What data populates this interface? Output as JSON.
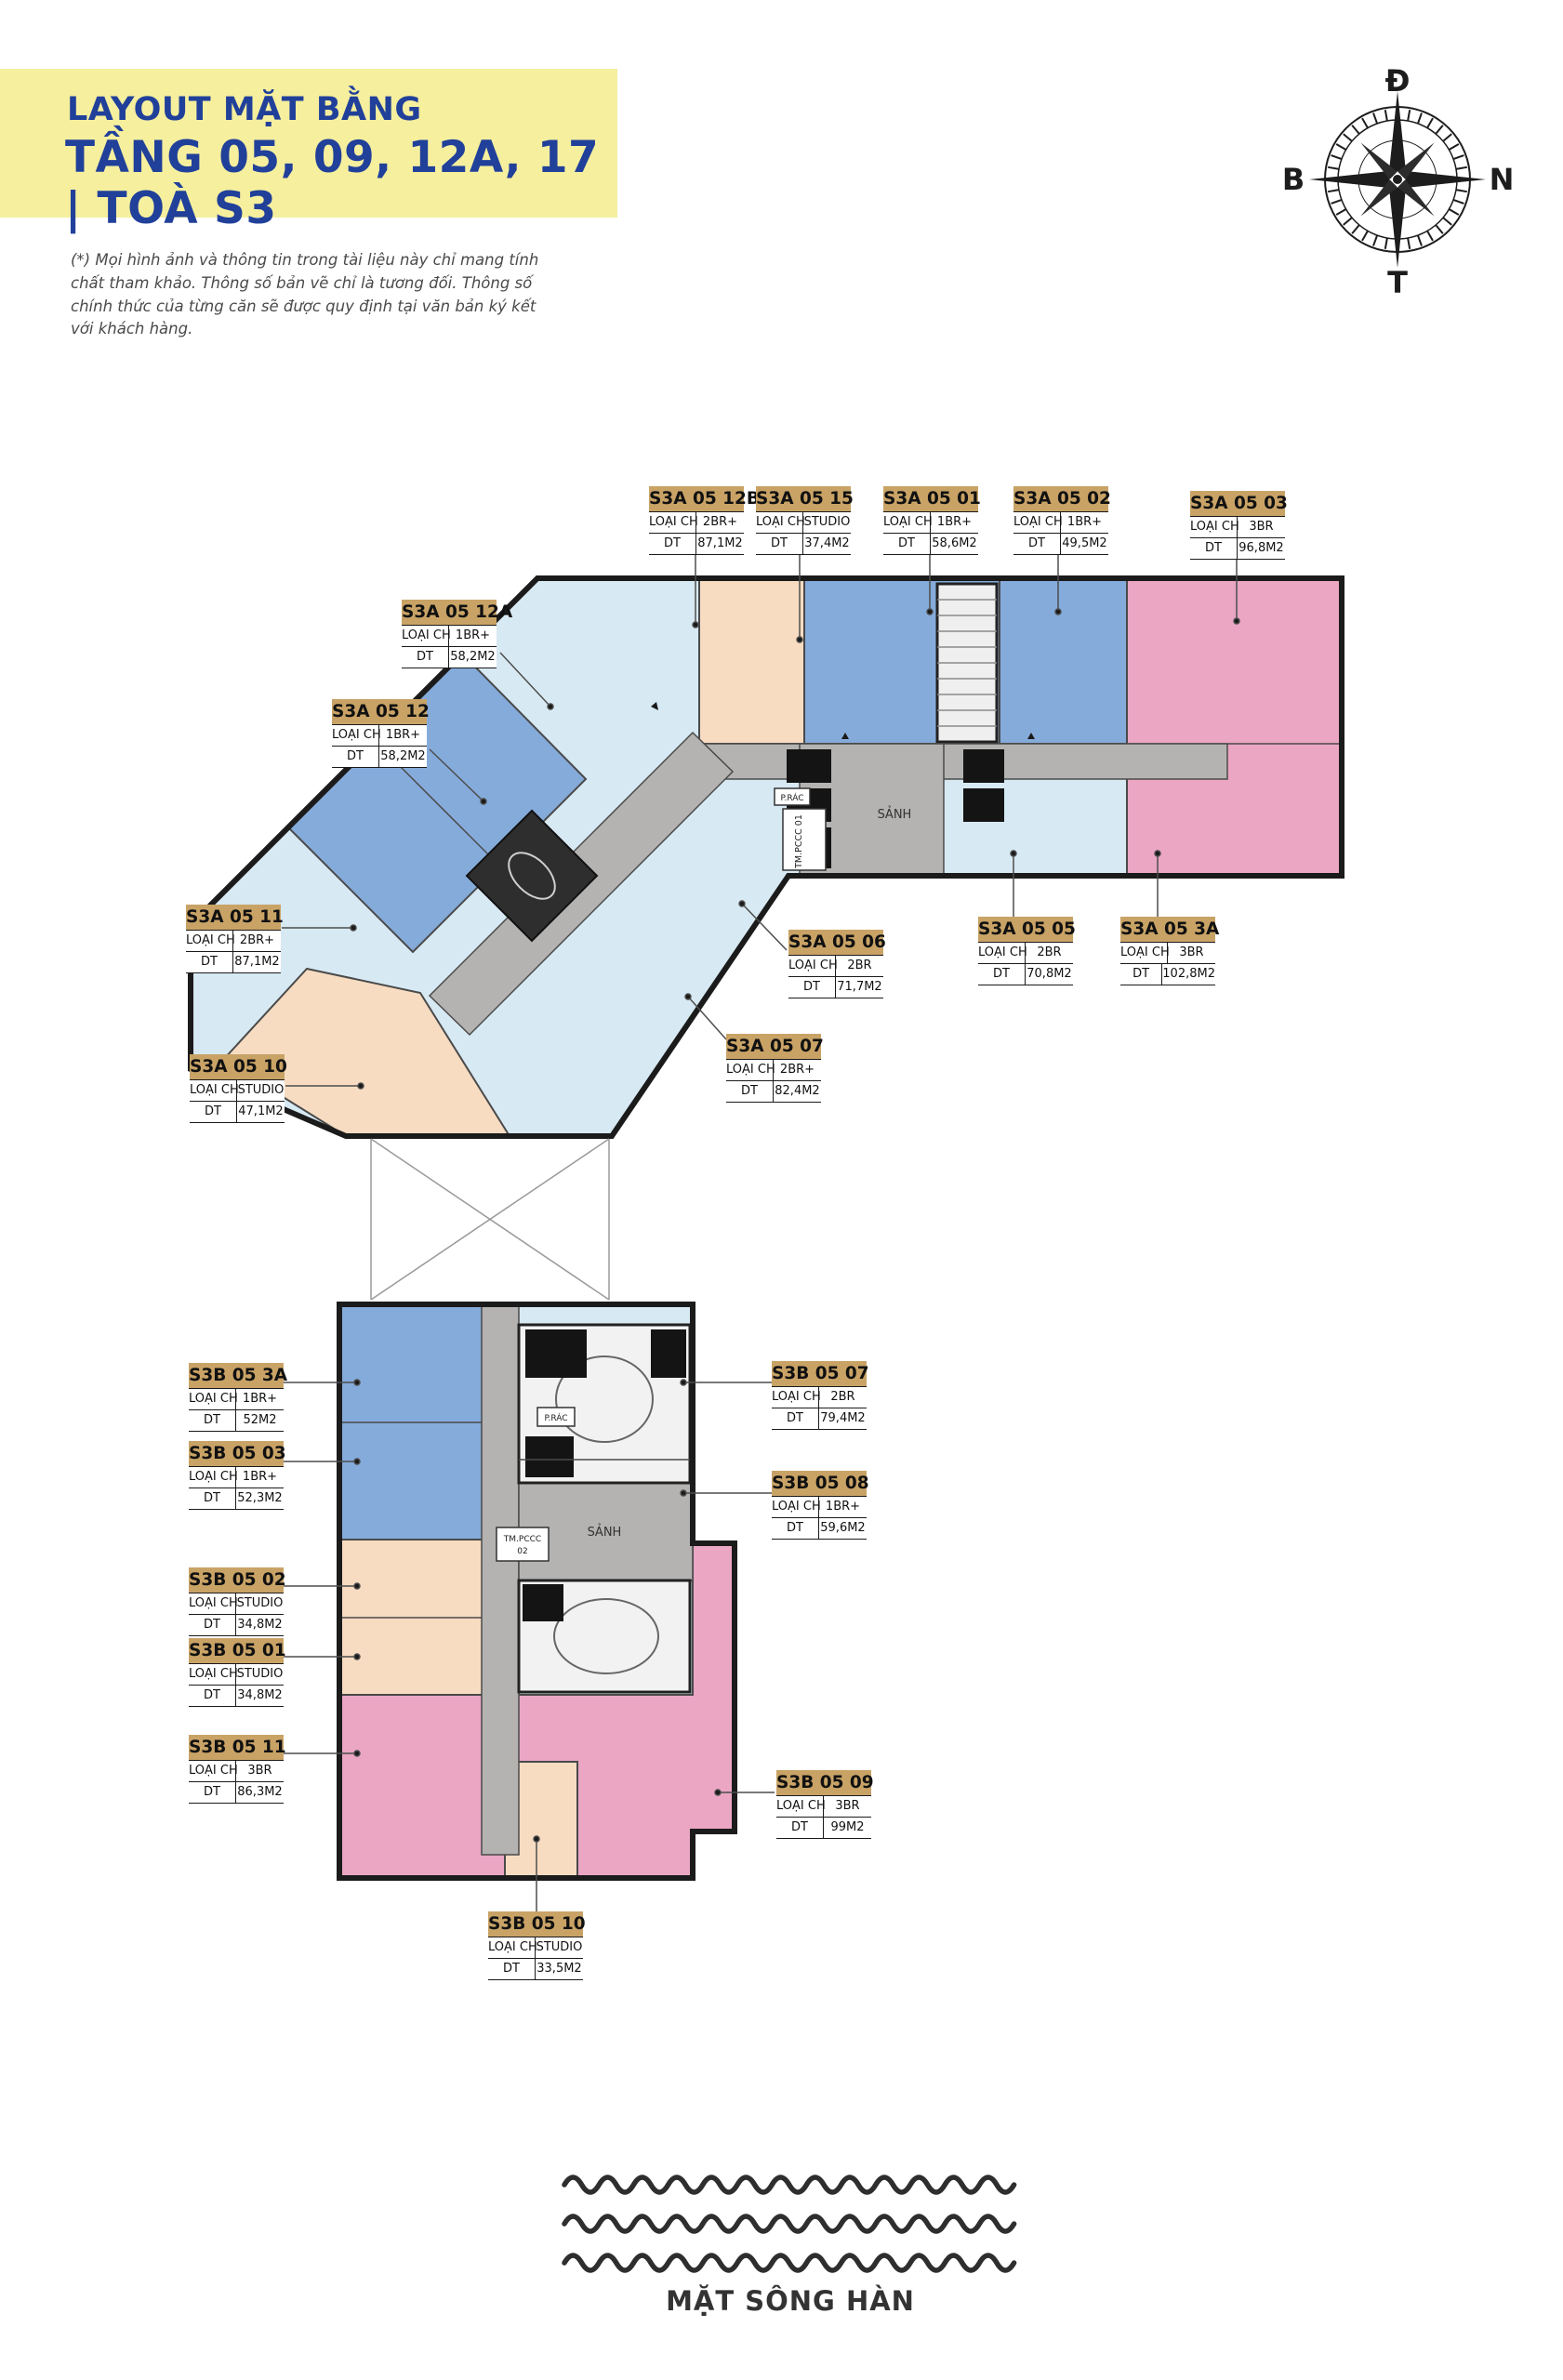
{
  "header": {
    "title": "LAYOUT MẶT BẰNG",
    "subtitle": "TẦNG 05, 09, 12A, 17 | TOÀ S3"
  },
  "disclaimer": "(*) Mọi hình ảnh và thông tin trong tài liệu này chỉ mang tính chất tham khảo. Thông số bản vẽ chỉ là tương đối. Thông số chính thức của từng căn sẽ được quy định tại văn bản ký kết với khách hàng.",
  "compass": {
    "top": "Đ",
    "right": "N",
    "bottom": "T",
    "left": "B"
  },
  "unit_label_fields": {
    "type": "LOẠI CH",
    "area": "DT"
  },
  "plan_rooms": {
    "lobby_a": "SẢNH",
    "lobby_b": "SẢNH",
    "fire_tech_1": "TM.PCCC 01",
    "fire_tech_2_line1": "TM.PCCC",
    "fire_tech_2_line2": "02",
    "trash_a": "P.RÁC",
    "trash_b": "P.RÁC"
  },
  "river": {
    "label": "MẶT SÔNG HÀN"
  },
  "units": {
    "s3a": [
      {
        "id": "S3A 05 12B",
        "type": "2BR+",
        "area": "87,1M2"
      },
      {
        "id": "S3A 05 15",
        "type": "STUDIO",
        "area": "37,4M2"
      },
      {
        "id": "S3A 05 01",
        "type": "1BR+",
        "area": "58,6M2"
      },
      {
        "id": "S3A 05 02",
        "type": "1BR+",
        "area": "49,5M2"
      },
      {
        "id": "S3A 05 03",
        "type": "3BR",
        "area": "96,8M2"
      },
      {
        "id": "S3A 05 12A",
        "type": "1BR+",
        "area": "58,2M2"
      },
      {
        "id": "S3A 05 12",
        "type": "1BR+",
        "area": "58,2M2"
      },
      {
        "id": "S3A 05 11",
        "type": "2BR+",
        "area": "87,1M2"
      },
      {
        "id": "S3A 05 10",
        "type": "STUDIO",
        "area": "47,1M2"
      },
      {
        "id": "S3A 05 06",
        "type": "2BR",
        "area": "71,7M2"
      },
      {
        "id": "S3A 05 07",
        "type": "2BR+",
        "area": "82,4M2"
      },
      {
        "id": "S3A 05 05",
        "type": "2BR",
        "area": "70,8M2"
      },
      {
        "id": "S3A 05 3A",
        "type": "3BR",
        "area": "102,8M2"
      }
    ],
    "s3b": [
      {
        "id": "S3B 05 3A",
        "type": "1BR+",
        "area": "52M2"
      },
      {
        "id": "S3B 05 03",
        "type": "1BR+",
        "area": "52,3M2"
      },
      {
        "id": "S3B 05 07",
        "type": "2BR",
        "area": "79,4M2"
      },
      {
        "id": "S3B 05 08",
        "type": "1BR+",
        "area": "59,6M2"
      },
      {
        "id": "S3B 05 02",
        "type": "STUDIO",
        "area": "34,8M2"
      },
      {
        "id": "S3B 05 01",
        "type": "STUDIO",
        "area": "34,8M2"
      },
      {
        "id": "S3B 05 11",
        "type": "3BR",
        "area": "86,3M2"
      },
      {
        "id": "S3B 05 09",
        "type": "3BR",
        "area": "99M2"
      },
      {
        "id": "S3B 05 10",
        "type": "STUDIO",
        "area": "33,5M2"
      }
    ]
  },
  "colors": {
    "banner": "#f5ef9e",
    "title": "#21409a",
    "label_header": "#c9a366",
    "type_1br_plus": "#85abdb",
    "type_2br": "#d7e9f3",
    "type_3br": "#eba6c4",
    "type_studio": "#f7dcc2",
    "corridor": "#b5b3b1"
  }
}
